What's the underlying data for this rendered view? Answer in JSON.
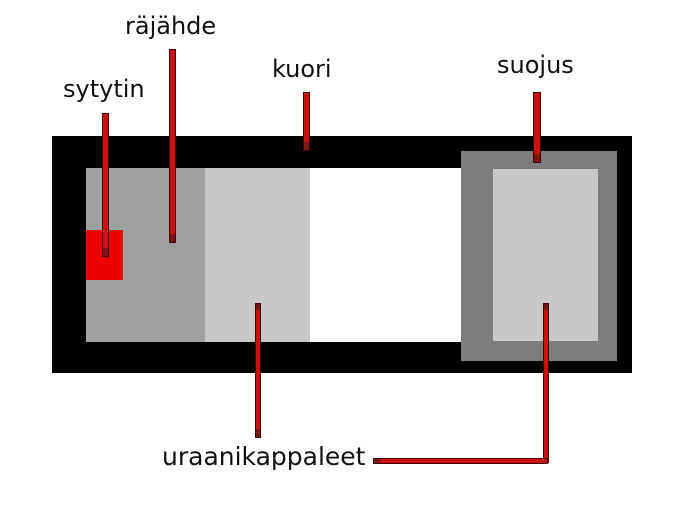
{
  "labels": {
    "sytytin": "sytytin",
    "rajahde": "räjähde",
    "kuori": "kuori",
    "suojus": "suojus",
    "uraanikappaleet": "uraanikappaleet"
  },
  "colors": {
    "background": "#ffffff",
    "casing": "#000000",
    "interior": "#ffffff",
    "explosive-gray": "#a0a0a0",
    "uranium-gray": "#c8c8c8",
    "shield-gray": "#7d7d7d",
    "detonator-red": "#ee0000",
    "line-red": "#cc1111",
    "line-edge": "#3f0505",
    "tip-dark-red": "#7f1414",
    "label-text": "#111111"
  }
}
